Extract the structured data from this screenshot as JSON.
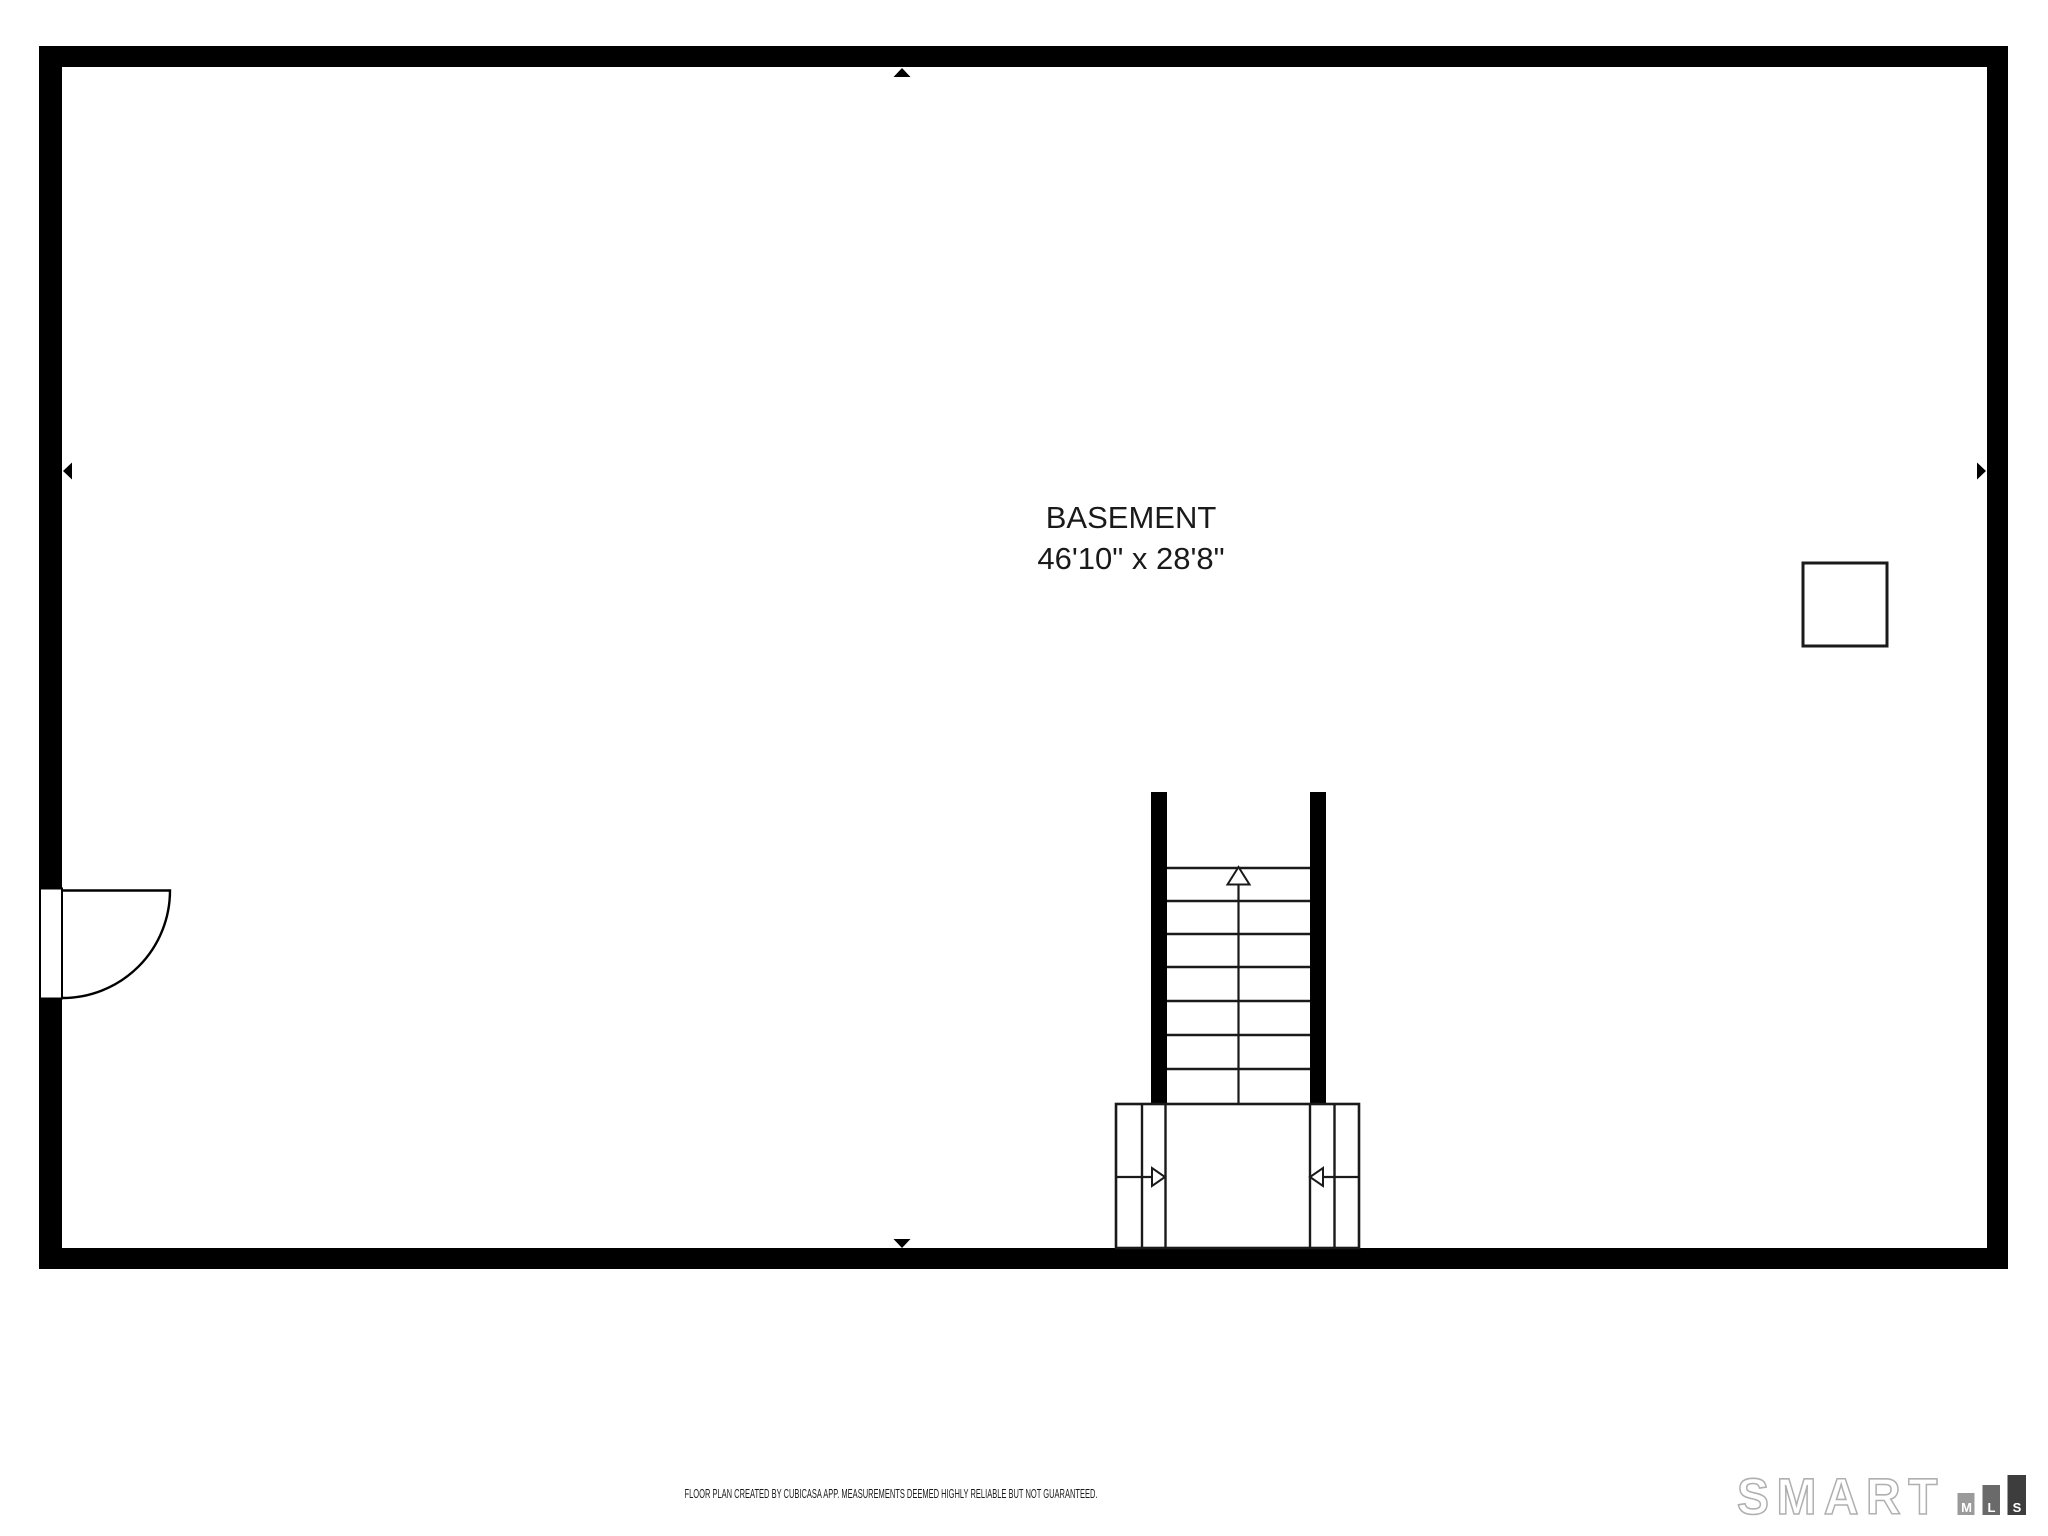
{
  "colors": {
    "background": "#ffffff",
    "wall": "#000000",
    "text": "#1a1a1a",
    "logo_outline": "#b0b0b0"
  },
  "room": {
    "label": "BASEMENT",
    "dimensions": "46'10\" x 28'8\""
  },
  "symbols": {
    "door": "quarter-circle-swing-door-on-left-wall",
    "staircase": "straight-staircase-with-up-arrow-and-lower-landing",
    "landing_arrows": [
      "right",
      "left"
    ],
    "utility_square": "square-outline-feature-right-side",
    "wall_markers": [
      "top-center-up",
      "left-middle-left",
      "right-middle-right",
      "bottom-center-down"
    ]
  },
  "footer": {
    "disclaimer": "FLOOR PLAN CREATED BY CUBICASA APP. MEASUREMENTS DEEMED HIGHLY RELIABLE BUT NOT GUARANTEED."
  },
  "logo": {
    "brand": "SMART",
    "bars": [
      {
        "letter": "M",
        "color": "#9b9b9b"
      },
      {
        "letter": "L",
        "color": "#6a6a6a"
      },
      {
        "letter": "S",
        "color": "#3d3d3d"
      }
    ]
  }
}
